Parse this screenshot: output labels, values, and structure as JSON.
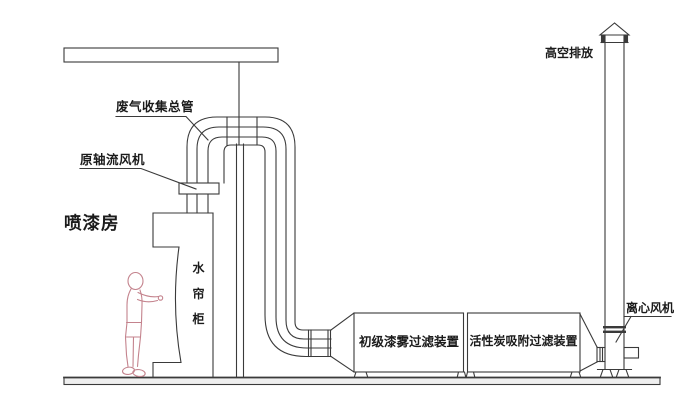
{
  "diagram": {
    "title_context": "spray booth exhaust gas treatment schematic",
    "labels": {
      "exhaust_collection_pipe": "废气收集总管",
      "original_axial_fan": "原轴流风机",
      "spray_booth": "喷漆房",
      "water_curtain_cabinet": "水帘柜",
      "high_altitude_discharge": "高空排放",
      "centrifugal_fan": "离心风机",
      "primary_paint_mist_filter": "初级漆雾过滤装置",
      "activated_carbon_filter": "活性炭吸附过滤装置"
    },
    "colors": {
      "line": "#3a3a3a",
      "person_outline": "#c4838d",
      "text": "#1b1b1b",
      "ground_fill": "#efefef",
      "background": "#ffffff"
    }
  }
}
